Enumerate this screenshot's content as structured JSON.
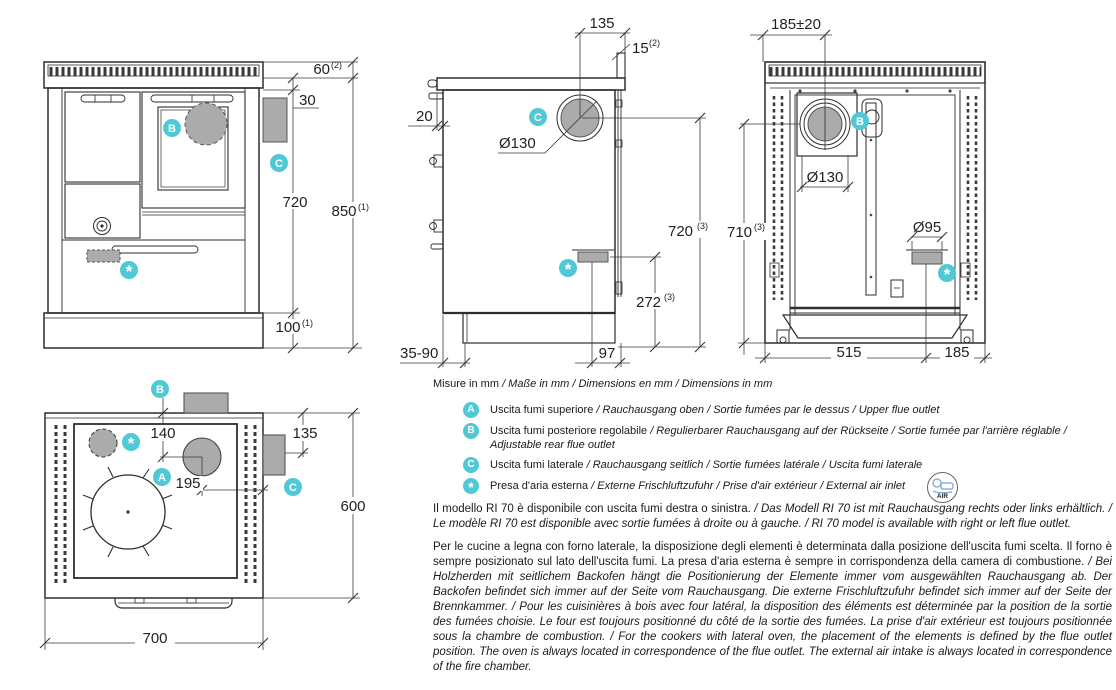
{
  "colors": {
    "accent": "#4ec9d5",
    "gray_fill": "#ababab",
    "line": "#2e2e2e"
  },
  "badges": {
    "a": "A",
    "b": "B",
    "c": "C",
    "star": "*"
  },
  "views": {
    "front": {
      "dims": {
        "rail_h": "60",
        "rail_h_sup": "(2)",
        "outlet_offset": "30",
        "body_h": "720",
        "total_h": "850",
        "total_h_sup": "(1)",
        "plinth_h": "100",
        "plinth_h_sup": "(1)"
      }
    },
    "side": {
      "dims": {
        "flue_to_back": "135",
        "splash_thk": "15",
        "splash_thk_sup": "(2)",
        "overhang": "20",
        "flue_dia": "Ø130",
        "flue_height": "720",
        "flue_height_sup": "(3)",
        "inlet_height": "272",
        "inlet_height_sup": "(3)",
        "plinth_range": "35-90",
        "inlet_to_back": "97"
      }
    },
    "rear": {
      "dims": {
        "flue_offset": "185±20",
        "flue_dia": "Ø130",
        "inlet_dia": "Ø95",
        "flue_height": "710",
        "flue_height_sup": "(3)",
        "inlet_x": "515",
        "edge_x": "185"
      }
    },
    "top": {
      "dims": {
        "a_depth": "140",
        "c_depth": "135",
        "a_to_side": "195",
        "depth": "600",
        "width": "700"
      }
    }
  },
  "legend": {
    "units": {
      "primary": "Misure in mm",
      "secondary": " / Maße in mm / Dimensions en mm / Dimensions in mm"
    },
    "items": [
      {
        "primary": "Uscita fumi superiore",
        "secondary": " / Rauchausgang oben  / Sortie fumées par le dessus / Upper flue outlet"
      },
      {
        "primary": "Uscita fumi posteriore regolabile",
        "secondary": " /  Regulierbarer Rauchausgang auf der Rückseite / Sortie fumée par l'arrière réglable / Adjustable rear flue outlet"
      },
      {
        "primary": "Uscita fumi laterale",
        "secondary": " / Rauchausgang seitlich  / Sortie fumées latérale / Uscita fumi laterale"
      },
      {
        "primary": "Presa d'aria esterna",
        "secondary": " / Externe Frischluftzufuhr / Prise d'air extérieur / External air inlet"
      }
    ],
    "air_icon_label": "AIR"
  },
  "notes": {
    "model": {
      "primary": "Il modello RI 70 è disponibile con uscita fumi destra o sinistra.",
      "secondary": " / Das Modell RI 70 ist mit Rauchausgang rechts oder links erhältlich. / Le modèle RI 70 est disponible avec sortie fumées à droite ou à gauche. / RI 70 model is available with right or left flue outlet."
    },
    "placement": {
      "primary": "Per le cucine a legna con forno laterale, la disposizione degli elementi è determinata dalla posizione dell'uscita fumi scelta. Il forno è sempre posizionato sul lato dell'uscita fumi. La presa d'aria esterna è sempre in corrispondenza della camera di combustione.",
      "secondary": " / Bei Holzherden mit seitlichem Backofen hängt die Positionierung der Elemente immer vom ausgewählten Rauchausgang ab. Der Backofen befindet sich immer auf der Seite vom Rauchausgang. Die externe Frischluftzufuhr befindet sich immer auf der Seite der Brennkammer. / Pour les cuisinières à bois avec four latéral, la disposition des éléments est déterminée par la position de la sortie des fumées choisie. Le four est toujours positionné du côté de la sortie des fumées. La prise d'air extérieur est toujours positionnée sous la chambre de combustion. / For the cookers with lateral oven, the placement of the elements is defined by the flue outlet position. The oven is always located in correspondence of the flue outlet. The external air intake is always located in correspondence of the fire chamber."
    }
  }
}
